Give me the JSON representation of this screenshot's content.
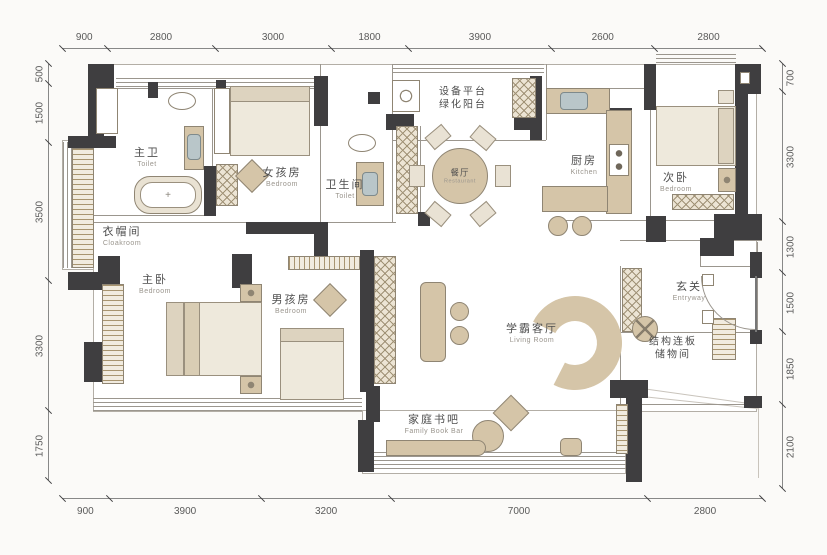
{
  "dims": {
    "top": [
      "900",
      "2800",
      "3000",
      "1800",
      "3900",
      "2600",
      "2800"
    ],
    "bottom": [
      "900",
      "3900",
      "3200",
      "7000",
      "2800"
    ],
    "left": [
      "500",
      "1500",
      "3500",
      "3300",
      "1750"
    ],
    "right": [
      "700",
      "3300",
      "1300",
      "1500",
      "1850",
      "2100"
    ]
  },
  "rooms": {
    "master_bath": {
      "zh": "主卫",
      "en": "Toilet"
    },
    "girls_room": {
      "zh": "女孩房",
      "en": "Bedroom"
    },
    "guest_bath": {
      "zh": "卫生间",
      "en": "Toilet"
    },
    "balcony": {
      "line1": "设备平台",
      "line2": "绿化阳台"
    },
    "dining": {
      "zh": "餐厅",
      "en": "Restaurant"
    },
    "kitchen": {
      "zh": "厨房",
      "en": "Kitchen"
    },
    "second_bedroom": {
      "zh": "次卧",
      "en": "Bedroom"
    },
    "cloakroom": {
      "zh": "衣帽间",
      "en": "Cloakroom"
    },
    "master_bedroom": {
      "zh": "主卧",
      "en": "Bedroom"
    },
    "boys_room": {
      "zh": "男孩房",
      "en": "Bedroom"
    },
    "living": {
      "zh": "学霸客厅",
      "en": "Living Room"
    },
    "entry": {
      "zh": "玄关",
      "en": "Entryway"
    },
    "storage": {
      "line1": "结构连板",
      "line2": "储物间"
    },
    "book_bar": {
      "zh": "家庭书吧",
      "en": "Family Book Bar"
    }
  },
  "fixtures": {
    "tub_mark": "+"
  },
  "colors": {
    "wall": "#3f3e40",
    "furniture": "#d5c5a8",
    "furniture_light": "#e9e2d4",
    "sink": "#b9c6c9",
    "floor": "#ffffff",
    "background": "#fbfaf8",
    "dimension_text": "#5a5a5a"
  }
}
